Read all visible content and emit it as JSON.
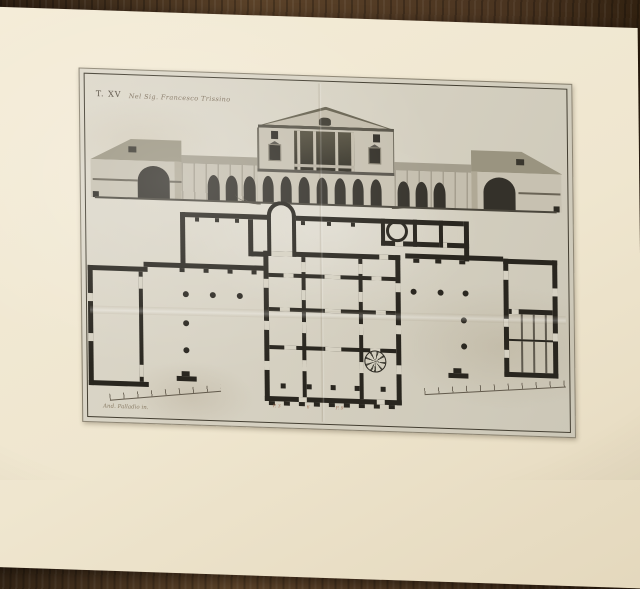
{
  "scene": {
    "type": "photograph",
    "subject": "Antique engraved plate of a Palladian villa (elevation above, ground plan below) on a cream mat over dark wood"
  },
  "colors": {
    "wood": "#4a3420",
    "mat": "#efe6d0",
    "paper": "#d6d1c2",
    "ink": "#2b2821",
    "wall_fill": "#c6c0b0",
    "roof_fill": "#9a9480"
  },
  "print": {
    "plate_number": "T. XV",
    "title_inscription": "Nel Sig. Francesco Trissino",
    "signature": "And. Palladio in.",
    "scale_marks": [
      "P. 3",
      "6",
      "P. 9"
    ]
  }
}
